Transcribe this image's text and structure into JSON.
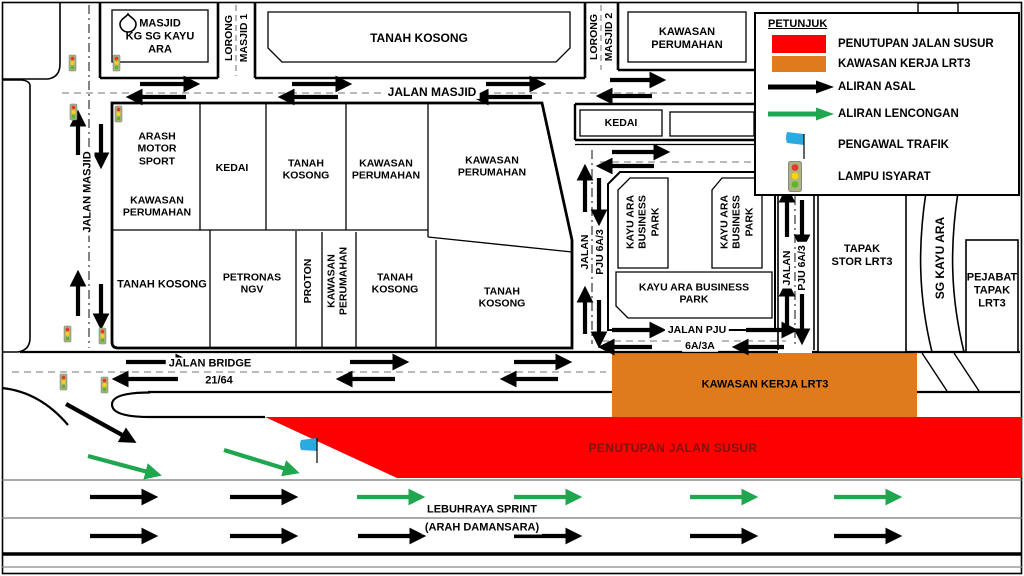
{
  "colors": {
    "closure_red": "#FF0000",
    "work_orange": "#E07B1D",
    "diversion_green": "#1FA64F",
    "original_black": "#000000",
    "flag_blue": "#29ABE2",
    "closure_label_text": "#7E120E"
  },
  "legend": {
    "title": "PETUNJUK",
    "items": [
      {
        "icon": "red-swatch",
        "label": "PENUTUPAN JALAN SUSUR"
      },
      {
        "icon": "orange-swatch",
        "label": "KAWASAN KERJA LRT3"
      },
      {
        "icon": "black-arrow-icon",
        "label": "ALIRAN ASAL"
      },
      {
        "icon": "green-arrow-icon",
        "label": "ALIRAN LENCONGAN"
      },
      {
        "icon": "blue-flag-icon",
        "label": "PENGAWAL TRAFIK"
      },
      {
        "icon": "traffic-light-icon",
        "label": "LAMPU ISYARAT"
      }
    ]
  },
  "roads": {
    "jalan_masjid_h": "JALAN MASJID",
    "jalan_masjid_v": "JALAN MASJID",
    "lorong_masjid_1": {
      "line1": "LORONG",
      "line2": "MASJID 1"
    },
    "lorong_masjid_2": {
      "line1": "LORONG",
      "line2": "MASJID 2"
    },
    "jalan_bridge": {
      "line1": "JALAN BRIDGE",
      "line2": "21/64"
    },
    "pju_6a3_left": {
      "line1": "JALAN",
      "line2": "PJU 6A/3"
    },
    "pju_6a3_right": {
      "line1": "JALAN",
      "line2": "PJU 6A/3"
    },
    "pju_6a3a": {
      "line1": "JALAN PJU",
      "line2": "6A/3A"
    },
    "sprint": {
      "line1": "LEBUHRAYA SPRINT",
      "line2": "(ARAH DAMANSARA)"
    },
    "sg_kayu_ara": "SG KAYU ARA"
  },
  "blocks": {
    "masjid": "MASJID\nKG SG KAYU\nARA",
    "tanah_kosong_top": "TANAH KOSONG",
    "kawasan_perumahan_topright": "KAWASAN\nPERUMAHAN",
    "kedai_top": "KEDAI",
    "arash": "ARASH\nMOTOR\nSPORT",
    "arash_kawasan": "KAWASAN\nPERUMAHAN",
    "kedai_left": "KEDAI",
    "tanah_kosong_r1": "TANAH\nKOSONG",
    "kawasan_perumahan_r1": "KAWASAN\nPERUMAHAN",
    "kawasan_perumahan_big": "KAWASAN\nPERUMAHAN",
    "tanah_kosong_r2a": "TANAH KOSONG",
    "petronas": "PETRONAS\nNGV",
    "proton": "PROTON",
    "kawasan_perumahan_vert": "KAWASAN\nPERUMAHAN",
    "tanah_kosong_r2b": "TANAH\nKOSONG",
    "tanah_kosong_big": "TANAH\nKOSONG",
    "kayu_ara_bp1": "KAYU ARA\nBUSINESS\nPARK",
    "kayu_ara_bp2": "KAYU ARA\nBUSINESS\nPARK",
    "kayu_ara_bp3": "KAYU ARA BUSINESS\nPARK",
    "tapak_stor": "TAPAK\nSTOR LRT3",
    "pejabat": "PEJABAT\nTAPAK\nLRT3"
  },
  "overlays": {
    "closure_label": "PENUTUPAN JALAN SUSUR",
    "work_area_label": "KAWASAN KERJA LRT3"
  }
}
